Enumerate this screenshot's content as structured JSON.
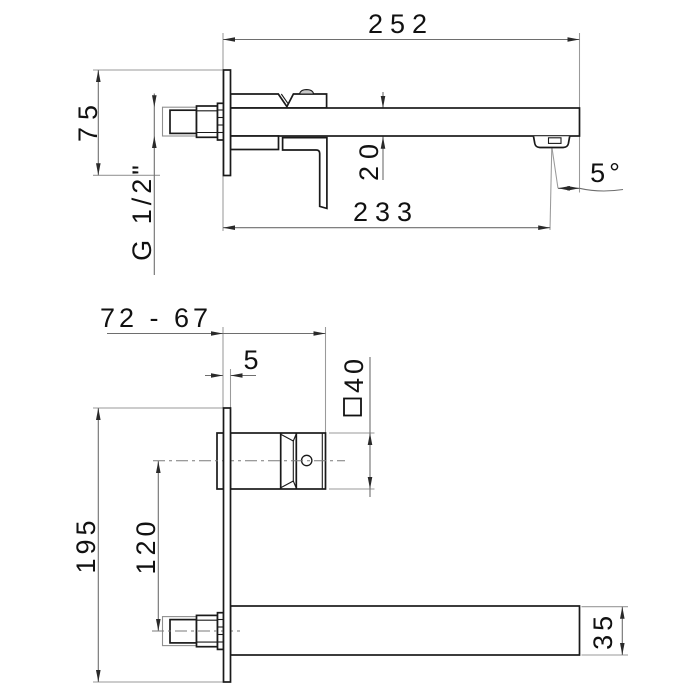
{
  "title": "Wall-mounted single-lever basin mixer - dimensioned technical drawing",
  "colors": {
    "object_line": "#1a1a1a",
    "dimension_line": "#6e6e6e",
    "extension_line": "#9a9a9a",
    "text": "#111111",
    "dome_shade": "#c9c9c9"
  },
  "views": {
    "top": {
      "name": "plan view of mixer with spout and lever",
      "dims": {
        "overall_projection": "252",
        "plate_width": "75",
        "spout_thickness": "20",
        "spout_reach": "233",
        "stream_angle": "5°",
        "inlet_thread": "G 1/2\""
      }
    },
    "front": {
      "name": "side elevation with wall plate, valve body and spout",
      "dims": {
        "depth_range": "72 - 67",
        "plate_thickness": "5",
        "handle_square": "40",
        "handle_square_symbol": "□",
        "plate_height": "195",
        "spout_axis_offset": "120",
        "spout_height": "35"
      }
    }
  }
}
